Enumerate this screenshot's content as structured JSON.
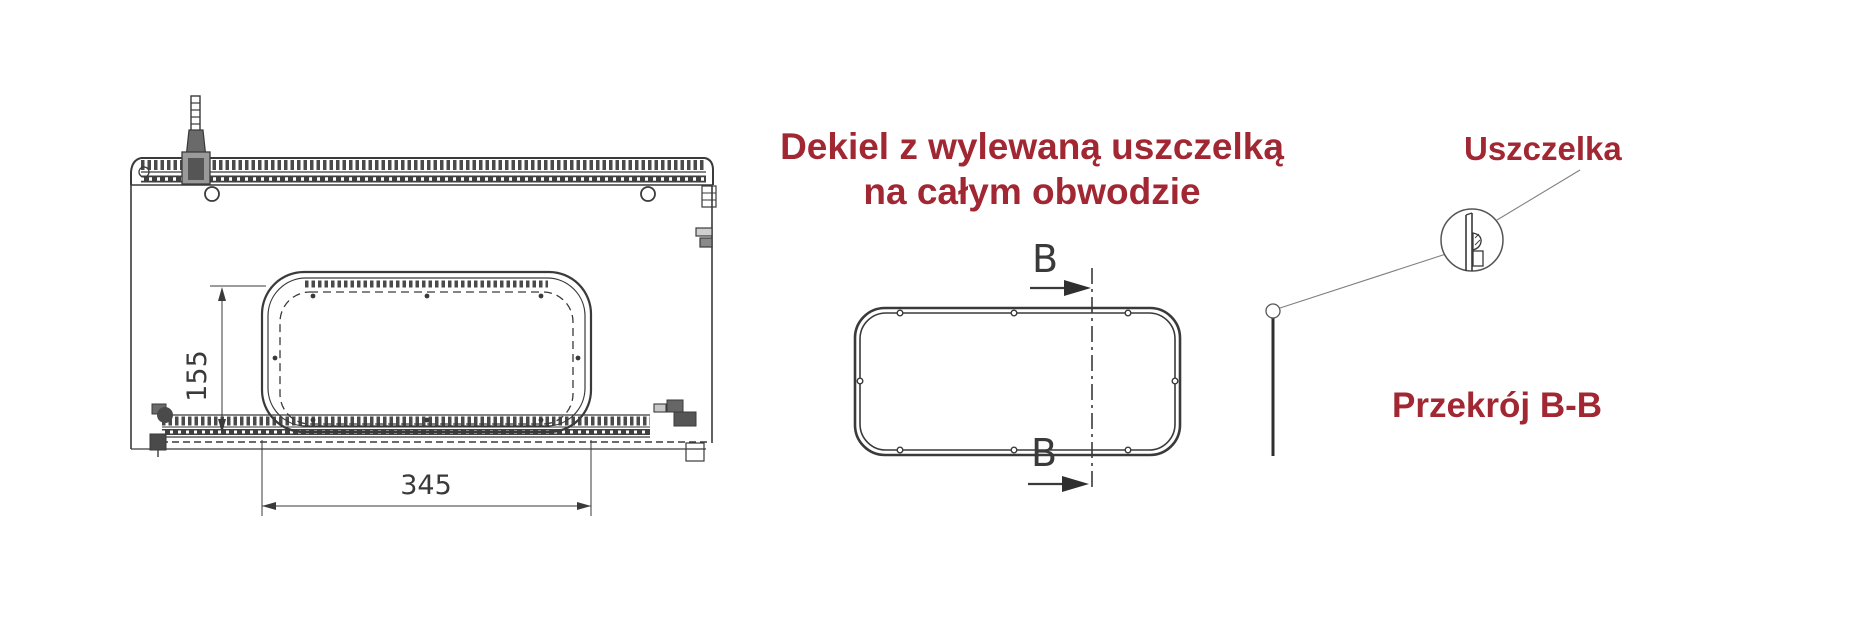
{
  "colors": {
    "accent_red": "#A12733",
    "line_dark": "#3A3A3A",
    "line_gray": "#808080",
    "background": "#FFFFFF"
  },
  "captions": {
    "main_line1": "Dekiel z wylewaną uszczelką",
    "main_line2": "na całym obwodzie",
    "gasket_label": "Uszczelka",
    "section_label": "Przekrój B-B"
  },
  "dimensions": {
    "cutout_height": "155",
    "cutout_width": "345"
  },
  "section_marks": {
    "top": "B",
    "bottom": "B"
  }
}
